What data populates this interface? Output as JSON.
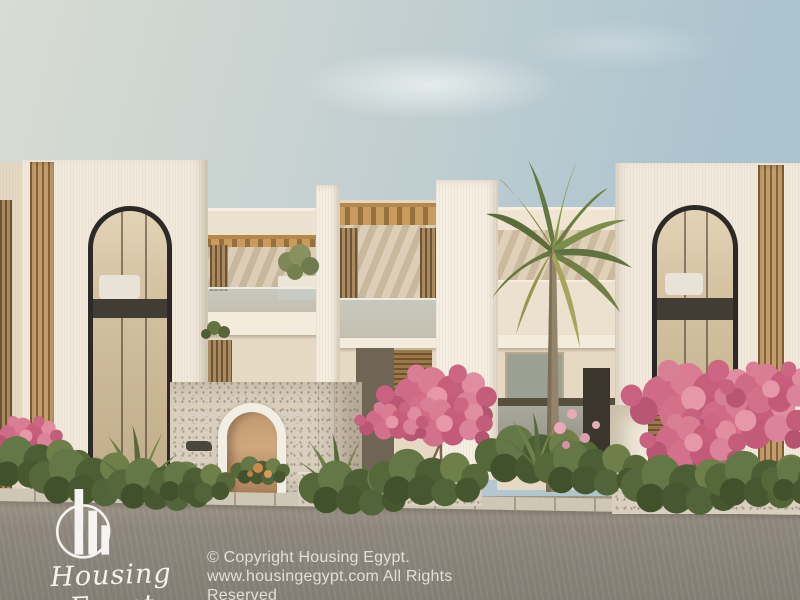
{
  "brand": {
    "name": "Housing Egypt",
    "logo_icon": "skyline-bars-in-circle-icon"
  },
  "watermark": {
    "copyright_line1": "© Copyright Housing Egypt.",
    "copyright_line2": "www.housingegypt.com All Rights Reserved"
  },
  "scene": {
    "type": "architectural-exterior-render",
    "description": "Modern cream-white residential complex with two tall arched-window towers, wooden louvers and pergolas, a central stone entrance arch, a palm tree, pink bougainvillea and a grey paved street",
    "colors": {
      "sky_left": "#d8dcd2",
      "sky_right": "#a7c1cd",
      "facade_cream": "#f0e9dc",
      "facade_back": "#e6d9c4",
      "wood_louver": "#c39d6b",
      "pergola_wood": "#c99c5e",
      "window_frame": "#2c2a26",
      "window_interior": "#d4c2a1",
      "stone_wall": "#d8cfc0",
      "street_grey": "#8f887e",
      "curb": "#cfc7b5",
      "palm_green": "#74864a",
      "bougainvillea_pink": "#cf6b86",
      "watermark_text": "#e9e6df"
    }
  }
}
